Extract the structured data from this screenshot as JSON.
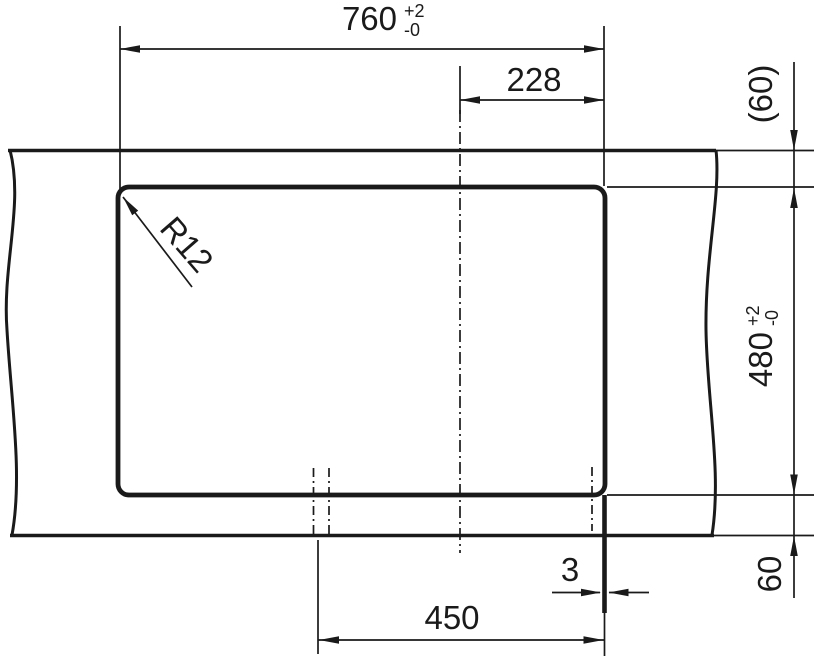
{
  "drawing": {
    "type": "technical-dimension-drawing",
    "background": "#ffffff",
    "line_color": "#1a1a1a",
    "dimensions": {
      "overall_width": {
        "value": "760",
        "tol_plus": "+2",
        "tol_minus": "-0"
      },
      "center_offset": {
        "value": "228"
      },
      "rear_margin_ref": {
        "value": "(60)"
      },
      "cutout_depth": {
        "value": "480",
        "tol_plus": "+2",
        "tol_minus": "-0"
      },
      "front_margin": {
        "value": "60"
      },
      "edge_gap": {
        "value": "3"
      },
      "drain_offset": {
        "value": "450"
      },
      "corner_radius": {
        "value": "R12"
      }
    }
  }
}
